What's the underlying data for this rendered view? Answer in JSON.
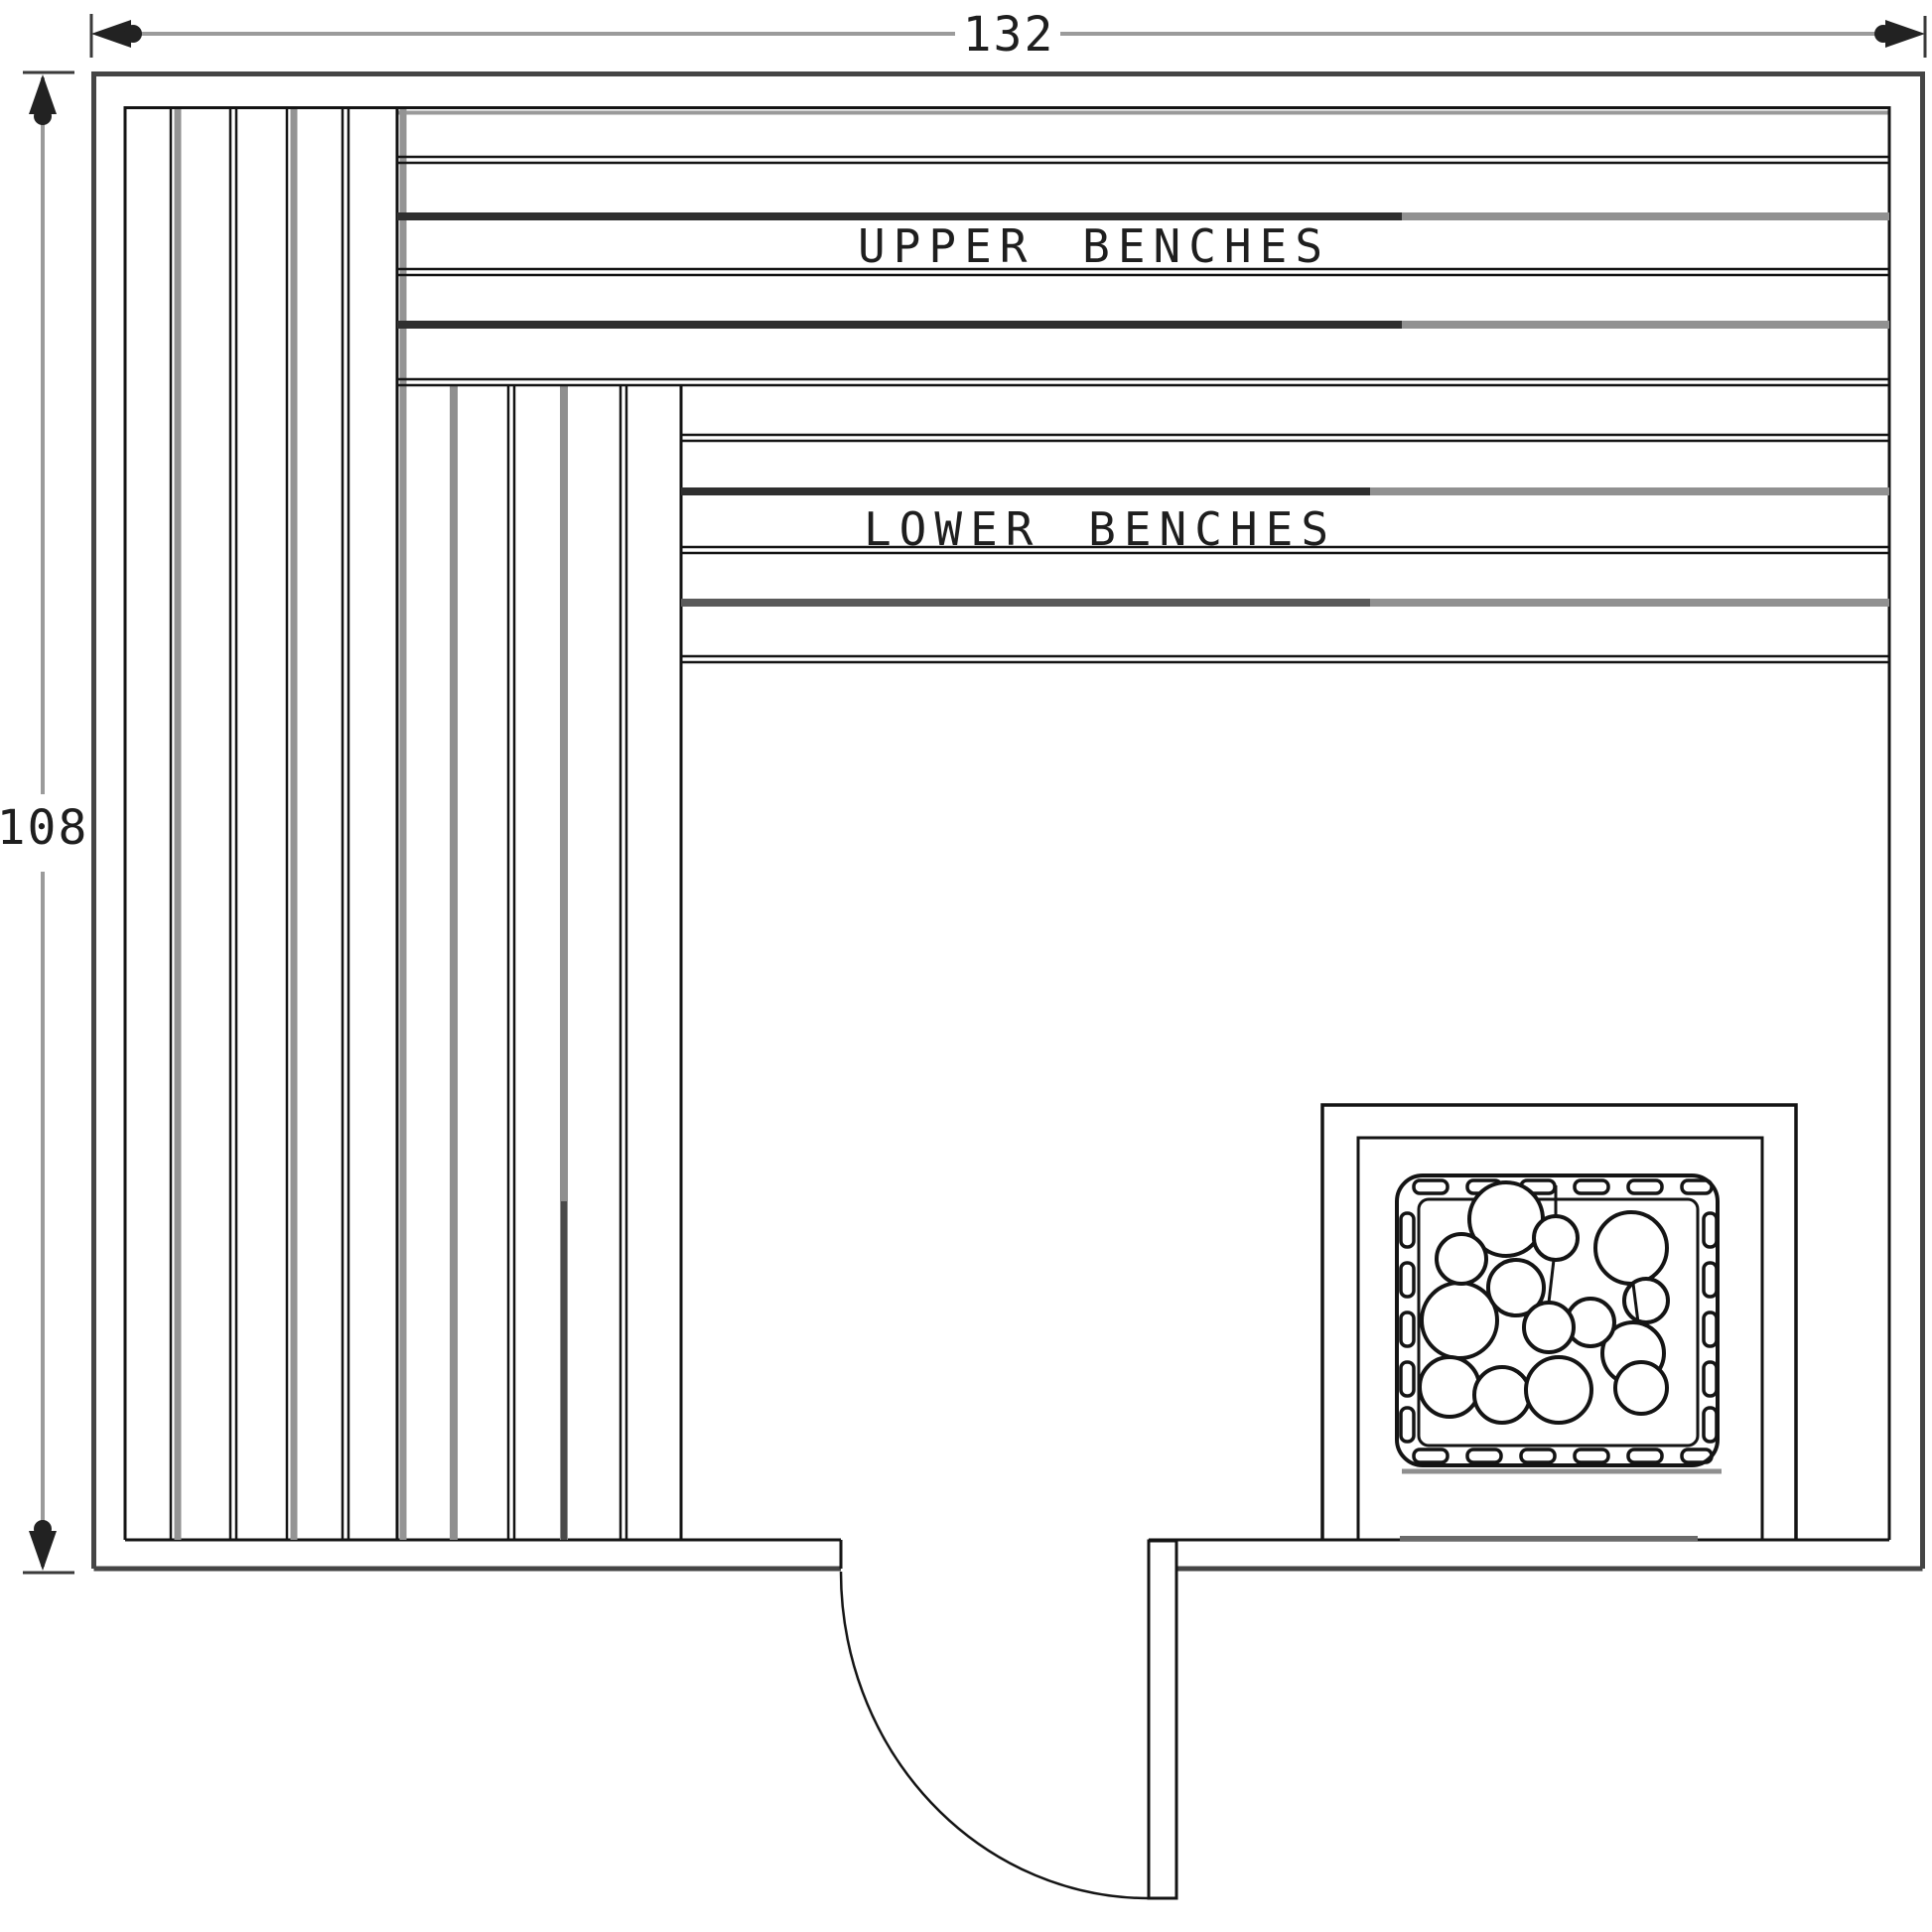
{
  "drawing": {
    "type_label": "sauna-floor-plan",
    "width_dimension": "132",
    "height_dimension": "108",
    "upper_bench_label": "UPPER BENCHES",
    "lower_bench_label": "LOWER BENCHES"
  },
  "icons": {
    "heater": "sauna-heater-with-rocks",
    "door": "door-swing-arc"
  },
  "colors": {
    "background": "#ffffff",
    "dimension_line": "#9b9b9b",
    "dimension_text": "#1e1e1e",
    "wall_outer": "#454545",
    "drawing_line": "#141414",
    "plank_shadow": "#949494",
    "plank_dark": "#2f2f2f",
    "plank_midgray": "#5a5a5a"
  }
}
